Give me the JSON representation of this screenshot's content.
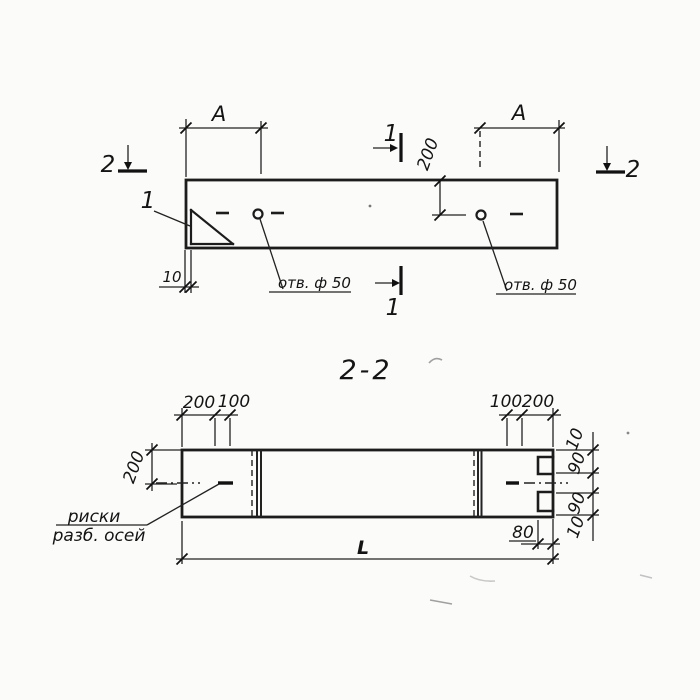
{
  "colors": {
    "ink": "#1c1c1c",
    "paper": "#fbfbfa"
  },
  "plan": {
    "mark_2_left": "2",
    "mark_2_right": "2",
    "mark_1_top": "1",
    "mark_1_bottom": "1",
    "callout_gusset": "1",
    "dim_a_left": "A",
    "dim_a_right": "A",
    "dim_200": "200",
    "dim_10": "10",
    "hole_label_left": "отв. ф 50",
    "hole_label_right": "отв. ф 50"
  },
  "section": {
    "title": "2-2",
    "dim_top_left_200": "200",
    "dim_top_left_100": "100",
    "dim_top_right_100": "100",
    "dim_top_right_200": "200",
    "dim_side_200": "200",
    "chain": [
      "10",
      "90",
      "90",
      "10"
    ],
    "dim_80": "80",
    "dim_length": "L",
    "note_line1": "риски",
    "note_line2": "разб. осей"
  }
}
